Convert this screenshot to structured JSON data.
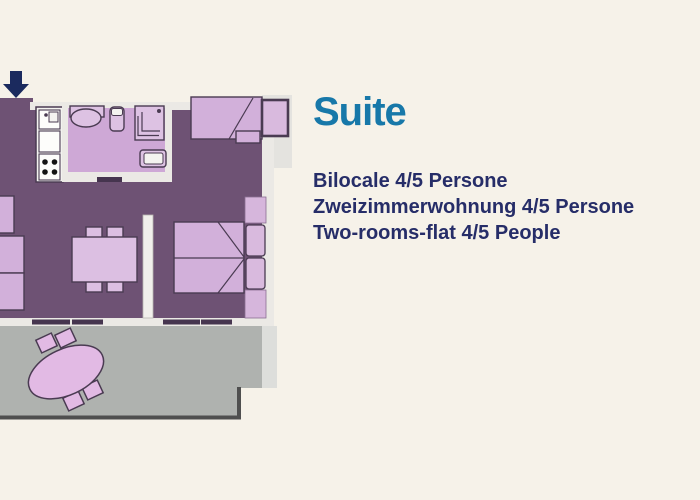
{
  "panel": {
    "title": "Suite",
    "lines": [
      "Bilocale 4/5 Persone",
      "Zweizimmerwohnung 4/5 Persone",
      "Two-rooms-flat 4/5 People"
    ]
  },
  "floorplan": {
    "entrance_arrow": "down-arrow-icon",
    "rooms": [
      "entrance",
      "kitchen",
      "bathroom",
      "living-room",
      "bedroom",
      "terrace"
    ],
    "furniture": [
      "kitchen-unit",
      "bathroom-sink",
      "toilet",
      "shower",
      "bidet",
      "armchair",
      "sofa",
      "dining-table-with-chairs",
      "sofa-bed",
      "double-bed",
      "wardrobe",
      "bed-pillows",
      "terrace-table-with-chairs"
    ]
  },
  "colors": {
    "background": "#f6f2e9",
    "title_color": "#1778a9",
    "text_color": "#262d68",
    "floor": "#6e5274",
    "bath_floor": "#cea8d6",
    "wall": "#ebe9e5",
    "wall_light": "#dddedb",
    "wall_corner": "#e4e3df",
    "divider": "#f1efeb",
    "terrace": "#afb2af",
    "terrace_edge": "#4f4f4f",
    "door": "#46354f",
    "furniture": "#d2b0da",
    "furniture_light": "#dcbfe2",
    "fixture": "#ddc2e3",
    "wardrobe": "#d6b6dc",
    "pillow": "#d9bade",
    "terrace_furniture": "#e2bae4",
    "outline": "#4a3b52",
    "arrow": "#1b2a5e"
  }
}
